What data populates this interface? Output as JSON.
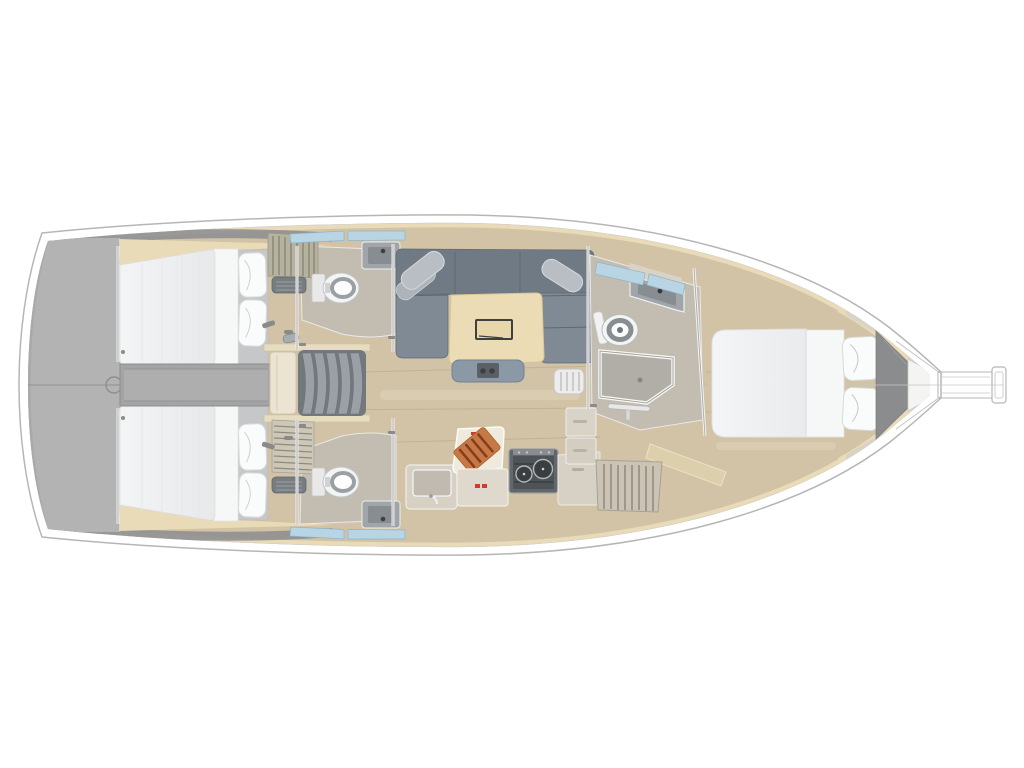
{
  "meta": {
    "title": "Sailing yacht interior layout plan — top-down view, bow to the right",
    "view": "overhead floor plan rendering",
    "visible_text": "none"
  },
  "palette": {
    "white": "#ffffff",
    "hull_stroke": "#b6b6b6",
    "deck_line": "#cdcdcd",
    "transom_gray": "#b3b3b3",
    "stern_dark": "#8f9092",
    "engine_gray": "#a4a4a4",
    "engine_gray_light": "#aeaeae",
    "wood": "#d2c3a6",
    "wood_seam": "#b3a282",
    "wood_streak": "#f0e6cc",
    "trim_cream": "#e9dab8",
    "wall_beige": "#c2bdb0",
    "panel_light": "#d8d3c6",
    "sofa_back": "#6f7a85",
    "sofa_seat": "#7f8a95",
    "sofa_seam": "#5d6873",
    "cushion_gray": "#b8bec3",
    "cushion_gray2": "#adb3b9",
    "mattress": "#eef0f0",
    "sheet": "#f6f7f7",
    "headboard": "#c5c7c8",
    "pillow": "#fafbfb",
    "table_cream": "#ecdcb6",
    "table_edge": "#d9c693",
    "table_inset_ink": "#3f3f3f",
    "bench_gray": "#8b98a5",
    "stool_white": "#ececec",
    "counter_beige": "#d7d1c5",
    "counter_beige2": "#dfd9cd",
    "prep_white": "#eeeade",
    "sink_top": "#9fa5a9",
    "basin_gray": "#878d91",
    "stove_body": "#62676b",
    "stove_panel": "#4e5357",
    "burner": "#3b3e41",
    "burner_rim": "#b4b7b9",
    "board_orange": "#c57a45",
    "board_stripe": "#8a3a1e",
    "red_accent": "#cf3b2e",
    "toilet_white": "#f3f4f4",
    "toilet_ring": "#9aa0a4",
    "shower_gray": "#b0aea6",
    "shower_rim": "#f5f5f3",
    "window_blue": "#b9d5e4",
    "window_edge": "#8fb4c8",
    "louver_beige": "#b6b2a0",
    "louver_beige2": "#cdc7b8",
    "vent_dark": "#787d81",
    "landing_cream": "#ece4d2",
    "stair_tread": "#9aa0a5",
    "stair_base": "#73787c",
    "stair_rail": "#e6dcc0",
    "hardware": "#8a8a8a",
    "bow_locker": "#8b8c8e",
    "backrest_sand": "#dccfab"
  },
  "regions": [
    {
      "id": "transom",
      "label": "Stern swim platform"
    },
    {
      "id": "aft-cabin-upper",
      "label": "Aft double cabin, upper side"
    },
    {
      "id": "aft-cabin-lower",
      "label": "Aft double cabin, lower side"
    },
    {
      "id": "aft-head-upper",
      "label": "Aft head with toilet and sink, upper side"
    },
    {
      "id": "aft-head-lower",
      "label": "Aft head with toilet and sink, lower side"
    },
    {
      "id": "engine-box",
      "label": "Engine compartment between aft cabins"
    },
    {
      "id": "companionway",
      "label": "Companionway steps with landing"
    },
    {
      "id": "saloon",
      "label": "Saloon with U-shaped settee and table"
    },
    {
      "id": "galley",
      "label": "Galley with sink, stove, lockers and cutting board"
    },
    {
      "id": "forward-head",
      "label": "Forward head with toilet, sink and shower"
    },
    {
      "id": "forward-cabin",
      "label": "Forward owner cabin with island double berth"
    },
    {
      "id": "bow",
      "label": "Bow anchor locker and bowsprit"
    }
  ]
}
